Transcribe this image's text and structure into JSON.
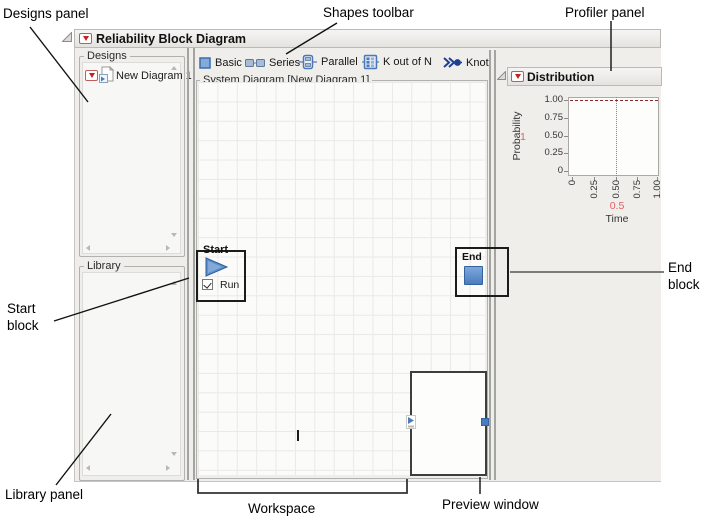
{
  "annotations": {
    "designs_panel": "Designs panel",
    "shapes_toolbar": "Shapes toolbar",
    "profiler_panel": "Profiler panel",
    "start_block": "Start block",
    "end_block": "End block",
    "library_panel": "Library panel",
    "workspace": "Workspace",
    "preview_window": "Preview window"
  },
  "window": {
    "title": "Reliability Block Diagram",
    "designs_panel": {
      "label": "Designs",
      "items": [
        {
          "label": "New Diagram 1",
          "icon": "diagram-document-icon"
        }
      ]
    },
    "library_panel": {
      "label": "Library"
    },
    "shapes_toolbar": {
      "buttons": [
        {
          "label": "Basic",
          "icon": "basic-shape-icon"
        },
        {
          "label": "Series",
          "icon": "series-shape-icon"
        },
        {
          "label": "Parallel",
          "icon": "parallel-shape-icon"
        },
        {
          "label": "K out of N",
          "icon": "k-out-of-n-shape-icon"
        },
        {
          "label": "Knot",
          "icon": "knot-shape-icon"
        }
      ]
    },
    "workspace": {
      "group_label": "System Diagram [New Diagram 1]",
      "start_block": {
        "label": "Start",
        "run_label": "Run",
        "run_checked": true
      },
      "end_block": {
        "label": "End"
      }
    },
    "profiler": {
      "title": "Distribution",
      "chart_data": {
        "type": "line",
        "xlabel": "Time",
        "ylabel": "Probability",
        "xlim": [
          0,
          1
        ],
        "ylim": [
          0,
          1
        ],
        "x_ticks": [
          "0",
          "0.25",
          "0.50",
          "0.75",
          "1.00"
        ],
        "y_ticks": [
          "1.00",
          "0.75",
          "0.50",
          "0.25",
          "0"
        ],
        "series": [
          {
            "name": "Reliability vs Time",
            "x": [
              0,
              1
            ],
            "y": [
              1,
              1
            ],
            "style": "dashed",
            "color": "#8b2a2a"
          }
        ],
        "crosshair": {
          "x": 0.5,
          "x_label": "0.5",
          "y": 1,
          "y_label": "1",
          "color": "#e06060"
        }
      }
    }
  },
  "colors": {
    "accent_blue": "#4a7cbe",
    "red_triangle": "#c42222",
    "series_line": "#8b2a2a",
    "crosshair": "#e06060",
    "panel_bg": "#efeeeb"
  }
}
